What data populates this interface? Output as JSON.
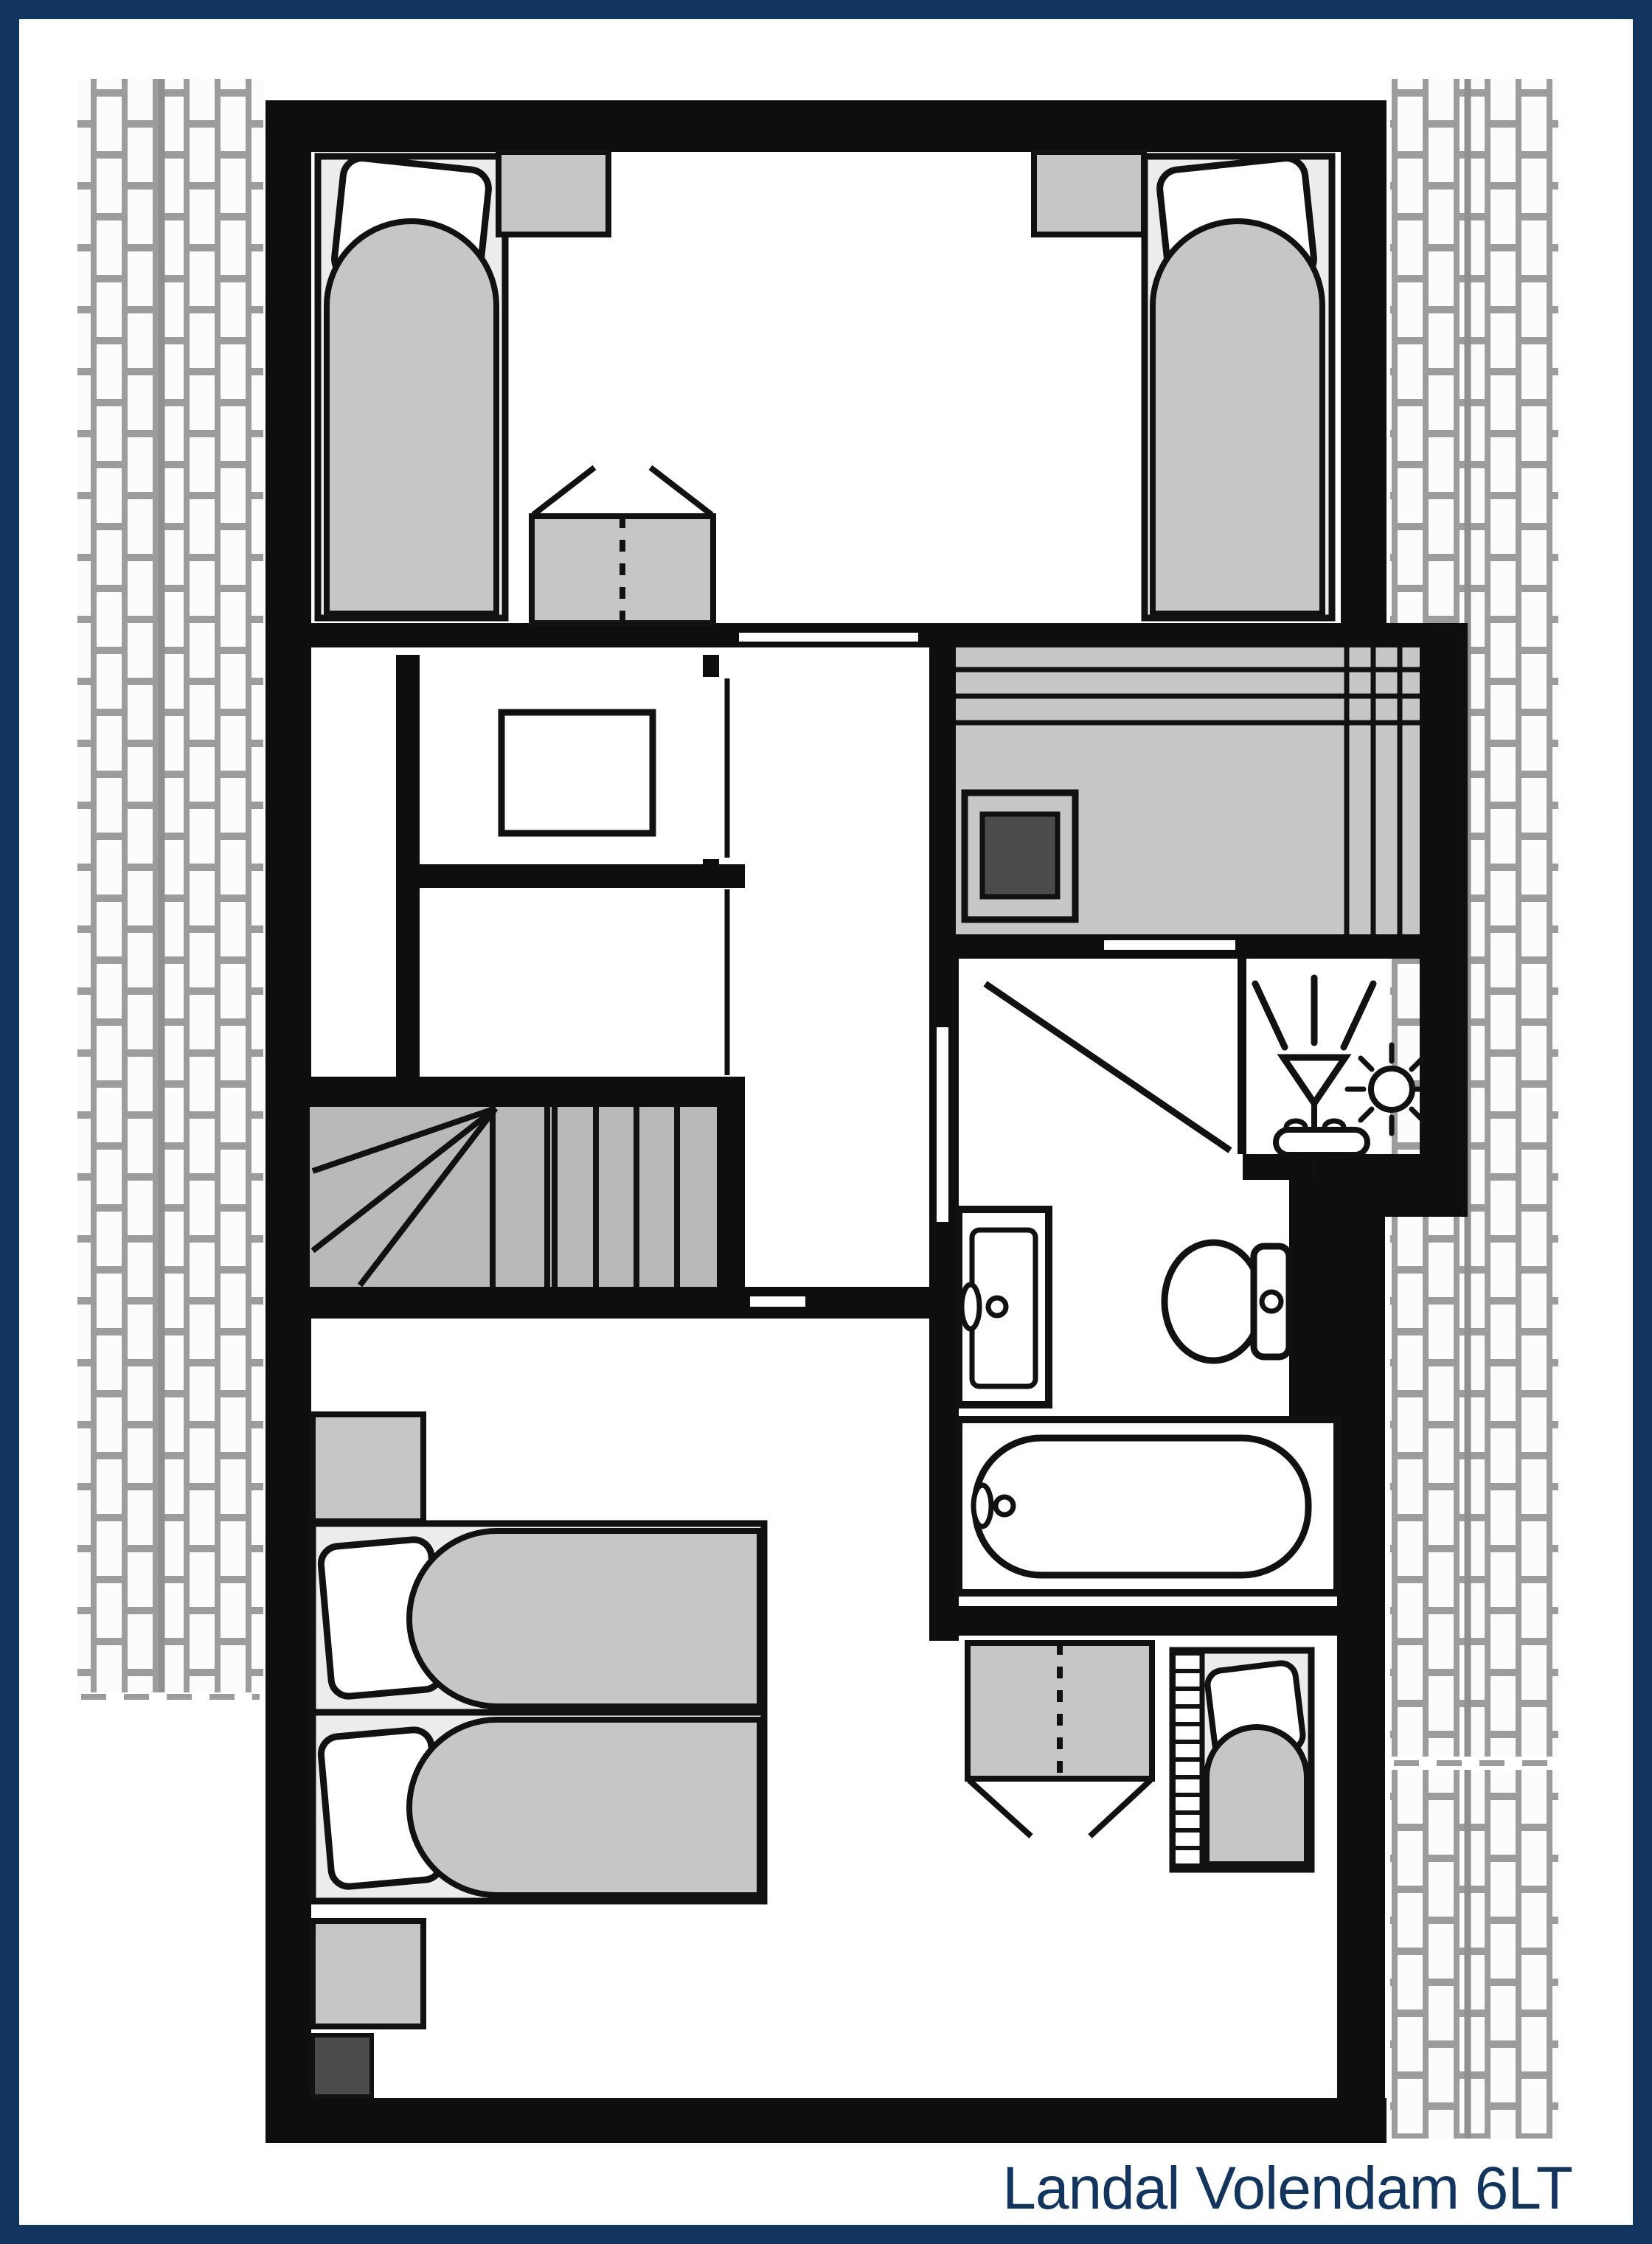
{
  "title": "Landal Volendam 6LT",
  "colors": {
    "frame_navy": "#11355f",
    "wall_black": "#0e0e0e",
    "furniture_gray": "#c6c6c6",
    "bed_linen_gray": "#ececec",
    "stairs_gray": "#b9b9b9",
    "sauna_gray": "#c7c7c7",
    "dark_gray": "#4b4b4b",
    "hatch_mortar_gray": "#9c9c9c"
  },
  "icons": {
    "shower": "shower-spray-icon",
    "sun": "sun-icon"
  }
}
